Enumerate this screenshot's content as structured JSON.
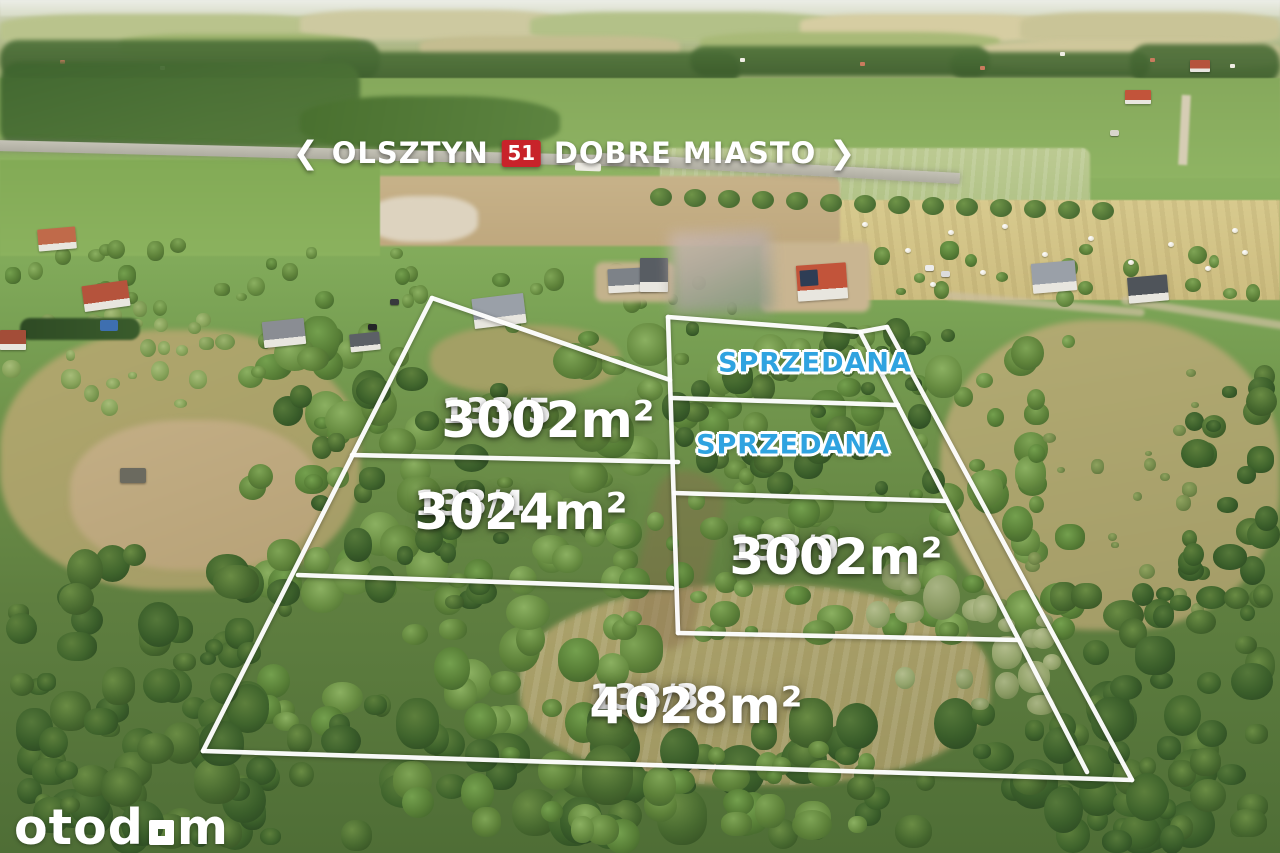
{
  "sign": {
    "left_chevron": "❮",
    "destination_left": "OLSZTYN",
    "route_number": "51",
    "destination_right": "DOBRE MIASTO",
    "right_chevron": "❯",
    "badge_color": "#c8232a"
  },
  "plots": [
    {
      "id": "133/5",
      "area": "3002m²",
      "status": "for-sale",
      "x": 548,
      "y": 420
    },
    {
      "id": "133/4",
      "area": "3024m²",
      "status": "for-sale",
      "x": 521,
      "y": 512
    },
    {
      "id": "133/9",
      "area": "3002m²",
      "status": "for-sale",
      "x": 836,
      "y": 557
    },
    {
      "id": "133/3",
      "area": "4028m²",
      "status": "for-sale",
      "x": 696,
      "y": 706
    }
  ],
  "sold_labels": [
    {
      "text": "SPRZEDANA",
      "x": 815,
      "y": 363
    },
    {
      "text": "SPRZEDANA",
      "x": 793,
      "y": 445
    }
  ],
  "boundary_lines": [
    [
      432,
      298,
      203,
      751
    ],
    [
      203,
      751,
      1132,
      780
    ],
    [
      1132,
      780,
      887,
      327
    ],
    [
      887,
      327,
      860,
      332
    ],
    [
      860,
      332,
      1087,
      772
    ],
    [
      668,
      317,
      860,
      332
    ],
    [
      668,
      317,
      678,
      633
    ],
    [
      432,
      298,
      670,
      380
    ],
    [
      672,
      398,
      898,
      405
    ],
    [
      674,
      493,
      946,
      501
    ],
    [
      678,
      633,
      1019,
      640
    ],
    [
      352,
      455,
      678,
      462
    ],
    [
      298,
      575,
      672,
      588
    ]
  ],
  "colors": {
    "sold_blue": "#2fa3e0",
    "boundary_white": "#ffffff",
    "badge_red": "#c8232a"
  },
  "logo": {
    "prefix": "otod",
    "suffix": "m"
  }
}
